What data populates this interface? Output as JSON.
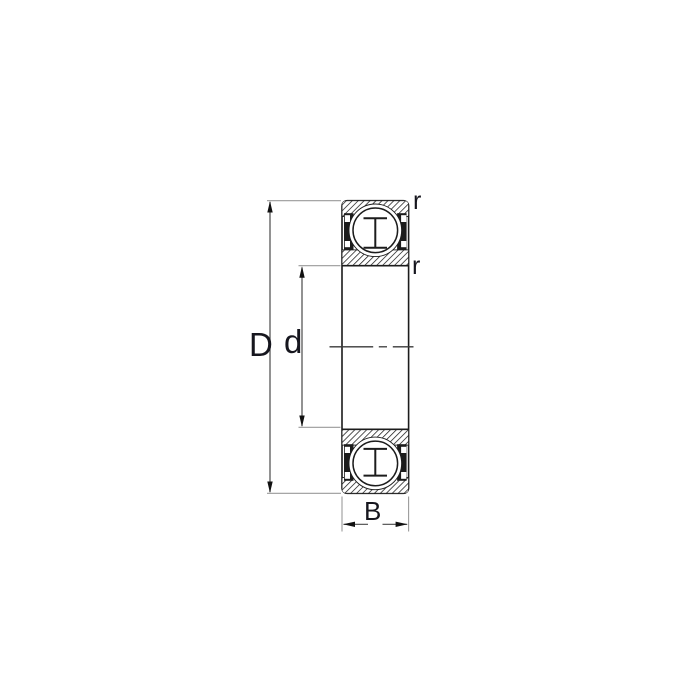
{
  "diagram": {
    "type": "deep-groove-ball-bearing-cross-section",
    "labels": {
      "outer_diameter": "D",
      "bore_diameter": "d",
      "width": "B",
      "radius_outer": "r",
      "radius_inner": "r"
    },
    "colors": {
      "background": "#ffffff",
      "line": "#1c1c1c",
      "dimension": "#4a4a4a",
      "extension": "#9a9a9a",
      "centerline": "#3a3a3a",
      "arrow": "#111111",
      "text": "#16161e"
    }
  }
}
